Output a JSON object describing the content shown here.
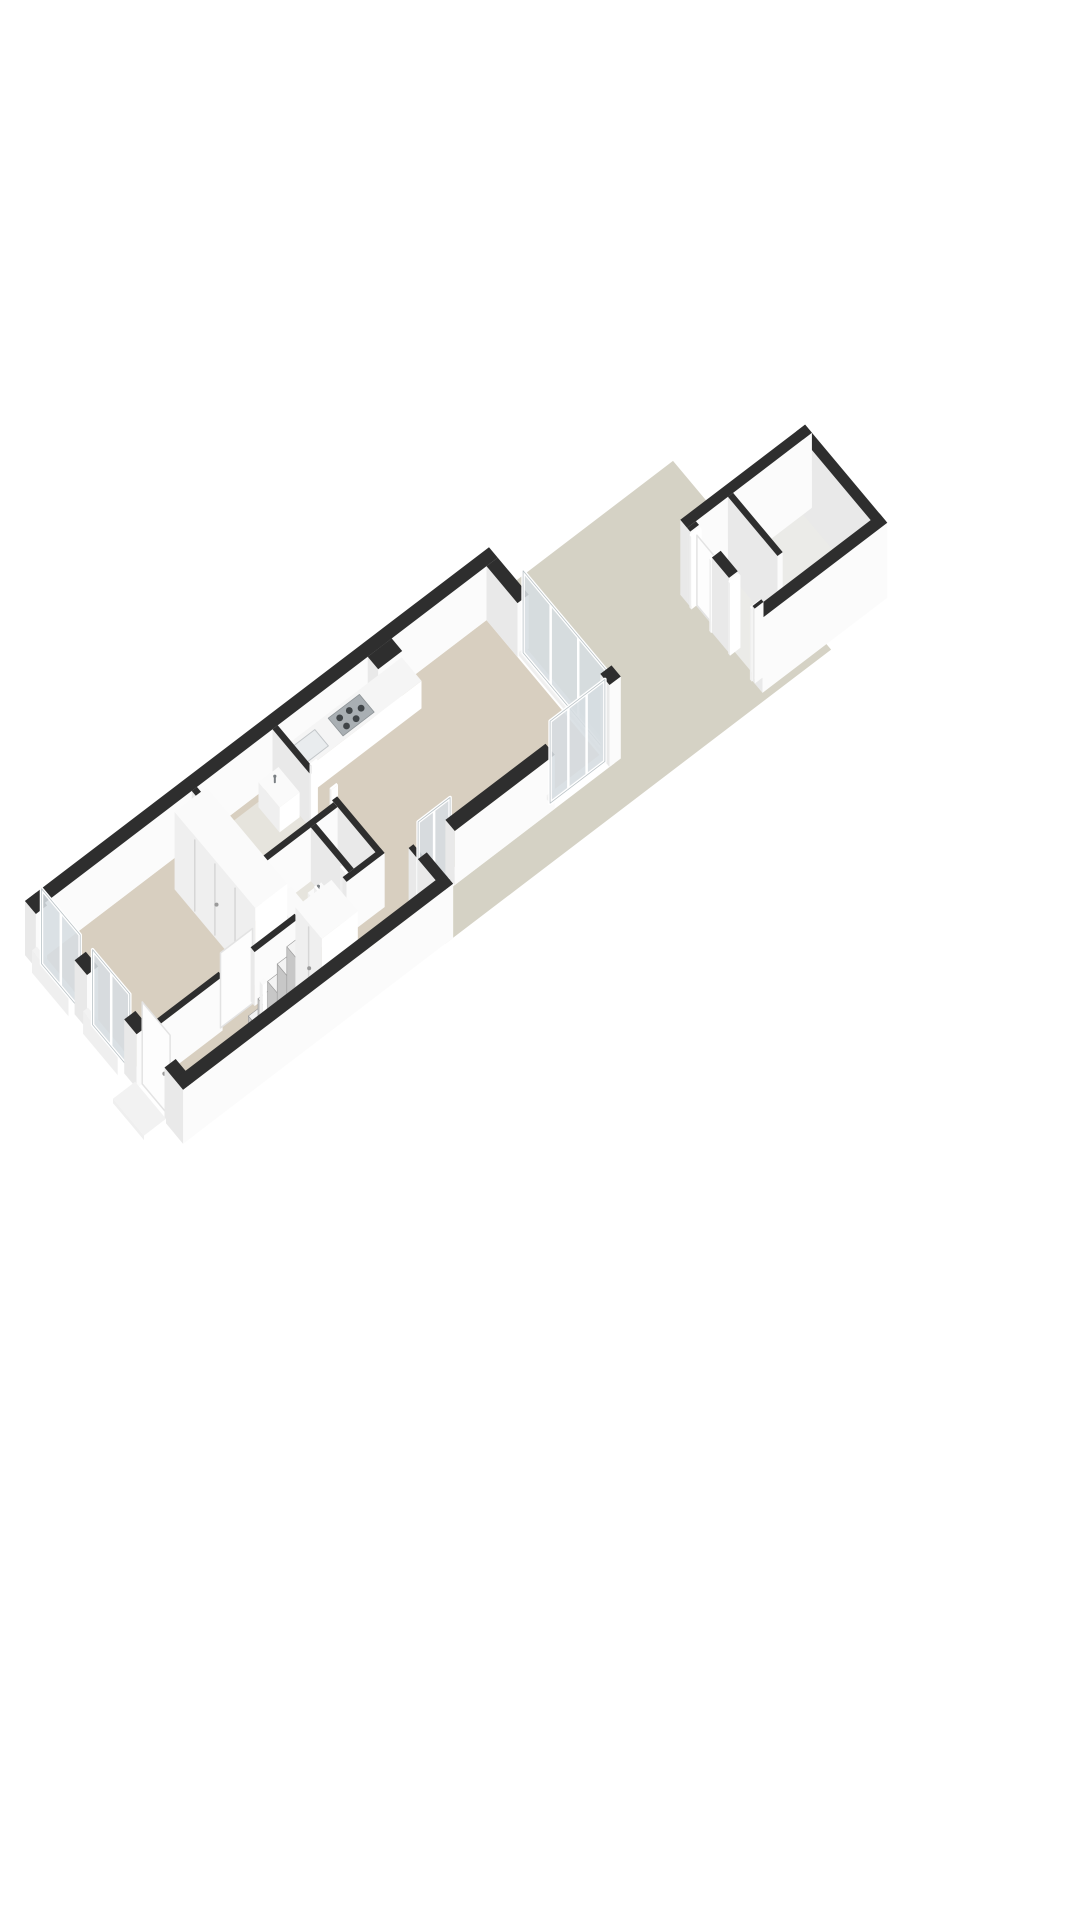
{
  "scene": {
    "width": 1080,
    "height": 1920,
    "background": "#ffffff",
    "projection": {
      "ox": 25,
      "oy": 955,
      "ux": 40,
      "uy": -30.5,
      "vx": 31,
      "vy": 37,
      "hz": 50
    },
    "colors": {
      "garden": "#d5d2c5",
      "floor": "#d8cfc0",
      "floor_wet": "#e6e4dd",
      "floor_shed": "#ebebe8",
      "wall_top": "#2e2e2e",
      "face_a": "#e9e9e9",
      "face_b": "#fbfbfb",
      "white_top": "#fafafa",
      "white_a": "#efefef",
      "white_b": "#ffffff",
      "glass": "#d6dde1",
      "frame": "#ffffff",
      "glass_edge": "#b9c2c6",
      "sill": "#f2f2f2",
      "counter_top": "#f5f5f5",
      "cooktop": "#a9afb3",
      "burner": "#3f4447",
      "sink_inset": "#e9ecee",
      "sink_edge": "#c2c6c9",
      "step_top": "#f3f3f3",
      "step_face": "#c7c7c7",
      "step_line": "#9b9b9b",
      "seam": "#d6d6d6",
      "handle": "#9a9a9a",
      "faucet": "#7a7f83",
      "leaf_edge": "#e3e3e3"
    },
    "elements": [
      {
        "type": "polygon",
        "name": "garden-floor",
        "fill": "garden",
        "pts": [
          [
            11.45,
            0
          ],
          [
            16.2,
            0
          ],
          [
            16.2,
            5.1
          ],
          [
            6.55,
            5.1
          ],
          [
            6.55,
            4.25
          ],
          [
            11.45,
            4.25
          ]
        ]
      },
      {
        "type": "polygon",
        "name": "shed-floor",
        "fill": "floor_shed",
        "pts": [
          [
            14.7,
            2.45
          ],
          [
            17.55,
            2.45
          ],
          [
            17.55,
            4.75
          ],
          [
            14.7,
            4.75
          ]
        ]
      },
      {
        "type": "box",
        "name": "shed-wall-back",
        "kind": "wall",
        "x": 17.5,
        "y": 2.3,
        "w": 0.22,
        "d": 2.62,
        "h": 1.5
      },
      {
        "type": "box",
        "name": "shed-wall-left",
        "kind": "wall",
        "x": 14.6,
        "y": 2.3,
        "w": 3.12,
        "d": 0.22,
        "h": 1.5
      },
      {
        "type": "box",
        "name": "shed-divider-wall",
        "kind": "wall",
        "x": 15.62,
        "y": 2.52,
        "w": 0.13,
        "d": 1.6,
        "h": 1.5
      },
      {
        "type": "box",
        "name": "shed-wall-front-right",
        "kind": "wall",
        "x": 14.6,
        "y": 4.7,
        "w": 3.12,
        "d": 0.25,
        "h": 1.5
      },
      {
        "type": "box",
        "name": "shed-front-wall-seg",
        "kind": "wall",
        "x": 14.6,
        "y": 2.52,
        "w": 0.22,
        "d": 0.1,
        "h": 1.5
      },
      {
        "type": "box",
        "name": "shed-door-frame-post",
        "kind": "frame",
        "x": 14.58,
        "y": 2.62,
        "w": 0.26,
        "d": 0.06,
        "h": 1.45
      },
      {
        "type": "leaf",
        "name": "shed-door-leaf",
        "axis": "y",
        "x": 14.72,
        "y1": 2.68,
        "y2": 3.26,
        "h": 1.4
      },
      {
        "type": "box",
        "name": "shed-door-frame-post",
        "kind": "frame",
        "x": 14.58,
        "y": 3.26,
        "w": 0.26,
        "d": 0.06,
        "h": 1.45
      },
      {
        "type": "box",
        "name": "shed-front-wall-seg",
        "kind": "wall",
        "x": 14.6,
        "y": 3.32,
        "w": 0.22,
        "d": 0.55,
        "h": 1.5
      },
      {
        "type": "box",
        "name": "shed-door-frame-post",
        "kind": "frame",
        "x": 14.58,
        "y": 3.87,
        "w": 0.26,
        "d": 0.06,
        "h": 1.45
      },
      {
        "type": "box",
        "name": "shed-door-frame-post",
        "kind": "frame",
        "x": 14.58,
        "y": 4.57,
        "w": 0.26,
        "d": 0.06,
        "h": 1.45
      },
      {
        "type": "box",
        "name": "shed-front-wall-seg",
        "kind": "wall",
        "x": 14.6,
        "y": 4.63,
        "w": 0.22,
        "d": 0.07,
        "h": 1.5
      },
      {
        "type": "polygon",
        "name": "house-floor",
        "fill": "floor",
        "pts": [
          [
            0.28,
            0.28
          ],
          [
            11.32,
            0.28
          ],
          [
            11.32,
            3.95
          ],
          [
            6.53,
            3.95
          ],
          [
            6.53,
            4.82
          ],
          [
            0.28,
            4.82
          ]
        ]
      },
      {
        "type": "polygon",
        "name": "bathroom-floor",
        "fill": "floor_wet",
        "pts": [
          [
            4.08,
            0.41
          ],
          [
            5.97,
            0.41
          ],
          [
            5.97,
            2.25
          ],
          [
            4.08,
            2.25
          ]
        ]
      },
      {
        "type": "polygon",
        "name": "toilet-floor",
        "fill": "floor_wet",
        "pts": [
          [
            4.08,
            2.38
          ],
          [
            5.3,
            2.38
          ],
          [
            5.3,
            3.6
          ],
          [
            4.08,
            3.6
          ]
        ]
      },
      {
        "type": "box",
        "name": "left-party-wall",
        "kind": "wall",
        "x": 0,
        "y": 0,
        "w": 11.6,
        "d": 0.28,
        "h": 1.08
      },
      {
        "type": "box",
        "name": "back-wall-segment",
        "kind": "wall",
        "x": 11.32,
        "y": 0.28,
        "w": 0.28,
        "d": 1.0,
        "h": 1.08
      },
      {
        "type": "box",
        "name": "sliding-door-sill",
        "kind": "sill",
        "x": 11.36,
        "y": 1.28,
        "w": 0.16,
        "d": 2.67,
        "h": 0.08
      },
      {
        "type": "glass",
        "name": "back-sliding-glass-door",
        "axis": "y",
        "x": 11.46,
        "y1": 1.28,
        "y2": 3.95,
        "h": 1.64,
        "panels": 3
      },
      {
        "type": "box",
        "name": "back-corner-post",
        "kind": "wall",
        "x": 11.32,
        "y": 3.95,
        "w": 0.28,
        "d": 0.3,
        "h": 1.64
      },
      {
        "type": "box",
        "name": "chimney-pier",
        "kind": "wall",
        "x": 8.35,
        "y": 0.28,
        "w": 0.6,
        "d": 0.34,
        "h": 1.08
      },
      {
        "type": "box",
        "name": "kitchen-counter",
        "kind": "counter",
        "x": 6.15,
        "y": 0.28,
        "w": 3.05,
        "d": 0.64,
        "h": 0.55
      },
      {
        "type": "toppoly",
        "name": "kitchen-sink-inset",
        "z": 0.55,
        "fill": "sink_inset",
        "stroke": "sink_edge",
        "pts": [
          [
            6.35,
            0.38
          ],
          [
            6.95,
            0.38
          ],
          [
            6.95,
            0.82
          ],
          [
            6.35,
            0.82
          ]
        ]
      },
      {
        "type": "cooktop",
        "name": "cooktop",
        "z": 0.55,
        "pts": [
          [
            7.3,
            0.36
          ],
          [
            8.08,
            0.36
          ],
          [
            8.08,
            0.84
          ],
          [
            7.3,
            0.84
          ]
        ],
        "burners": [
          [
            7.48,
            0.5
          ],
          [
            7.48,
            0.72
          ],
          [
            7.72,
            0.5
          ],
          [
            7.72,
            0.72
          ],
          [
            7.93,
            0.61
          ]
        ]
      },
      {
        "type": "box",
        "name": "bedroom-back-wall",
        "kind": "wall",
        "x": 3.95,
        "y": 0.28,
        "w": 0.13,
        "d": 3.45,
        "h": 1.08
      },
      {
        "type": "box",
        "name": "bathroom-wall-segment",
        "kind": "wall",
        "x": 5.97,
        "y": 0.28,
        "w": 0.13,
        "d": 1.22,
        "h": 1.08
      },
      {
        "type": "box",
        "name": "bathroom-door-post",
        "kind": "frame",
        "x": 5.95,
        "y": 1.5,
        "w": 0.17,
        "d": 0.05,
        "h": 1.3
      },
      {
        "type": "box",
        "name": "bathroom-door-post",
        "kind": "frame",
        "x": 5.95,
        "y": 2.15,
        "w": 0.17,
        "d": 0.05,
        "h": 1.3
      },
      {
        "type": "box",
        "name": "bathroom-wall-segment",
        "kind": "wall",
        "x": 5.97,
        "y": 2.2,
        "w": 0.13,
        "d": 1.53,
        "h": 1.08
      },
      {
        "type": "box",
        "name": "bathroom-toilet-divider-wall",
        "kind": "wall",
        "x": 4.08,
        "y": 2.25,
        "w": 1.89,
        "d": 0.13,
        "h": 1.08
      },
      {
        "type": "box",
        "name": "toilet-side-wall",
        "kind": "wall",
        "x": 5.3,
        "y": 2.38,
        "w": 0.13,
        "d": 1.22,
        "h": 1.08
      },
      {
        "type": "basin",
        "name": "bathroom-sink",
        "x": 5.45,
        "y": 0.5,
        "w": 0.5,
        "d": 0.68,
        "h": 0.5
      },
      {
        "type": "basin",
        "name": "toilet-hand-basin",
        "x": 4.82,
        "y": 2.9,
        "w": 0.34,
        "d": 0.42,
        "h": 0.45
      },
      {
        "type": "box",
        "name": "toilet-bowl",
        "kind": "white",
        "x": 4.25,
        "y": 2.55,
        "w": 0.42,
        "d": 0.55,
        "h": 0.4
      },
      {
        "type": "box",
        "name": "bedroom-closet",
        "kind": "white",
        "x": 3.12,
        "y": 0.8,
        "w": 0.8,
        "d": 2.6,
        "h": 1.55,
        "seams": [
          0.25,
          0.5,
          0.75
        ],
        "handle": true
      },
      {
        "type": "box",
        "name": "hall-wall-segment",
        "kind": "wall",
        "x": 0.28,
        "y": 3.6,
        "w": 1.77,
        "d": 0.13,
        "h": 1.08
      },
      {
        "type": "leaf",
        "name": "bedroom-door-leaf",
        "axis": "x",
        "x1": 2.05,
        "x2": 2.85,
        "y": 3.66,
        "h": 1.5
      },
      {
        "type": "box",
        "name": "hall-wall-segment",
        "kind": "wall",
        "x": 2.85,
        "y": 3.6,
        "w": 1.1,
        "d": 0.13,
        "h": 1.08
      },
      {
        "type": "box",
        "name": "toilet-hall-wall-segment",
        "kind": "wall",
        "x": 4.08,
        "y": 3.6,
        "w": 0.37,
        "d": 0.13,
        "h": 1.08
      },
      {
        "type": "box",
        "name": "toilet-door-post",
        "kind": "frame",
        "x": 4.45,
        "y": 3.58,
        "w": 0.05,
        "d": 0.17,
        "h": 1.3
      },
      {
        "type": "box",
        "name": "toilet-door-post",
        "kind": "frame",
        "x": 5.1,
        "y": 3.58,
        "w": 0.05,
        "d": 0.17,
        "h": 1.3
      },
      {
        "type": "box",
        "name": "toilet-hall-wall-segment",
        "kind": "wall",
        "x": 5.15,
        "y": 3.6,
        "w": 0.95,
        "d": 0.13,
        "h": 1.08
      },
      {
        "type": "steps",
        "name": "staircase",
        "x0": 2.5,
        "y": 3.98,
        "d": 0.78,
        "n": 5,
        "sw": 0.24,
        "hstep": 0.2
      },
      {
        "type": "box",
        "name": "stair-newel-post",
        "kind": "white",
        "x": 2.38,
        "y": 4.5,
        "w": 0.1,
        "d": 0.1,
        "h": 1.35
      },
      {
        "type": "box",
        "name": "stair-cupboard",
        "kind": "white",
        "x": 3.7,
        "y": 3.95,
        "w": 0.9,
        "d": 0.85,
        "h": 1.62,
        "seams": [
          0.5
        ],
        "handle": true
      },
      {
        "type": "box",
        "name": "living-side-wall-segment",
        "kind": "wall",
        "x": 6.53,
        "y": 3.95,
        "w": 0.12,
        "d": 0.3,
        "h": 1.08
      },
      {
        "type": "box",
        "name": "garden-door-sill",
        "kind": "sill",
        "x": 6.65,
        "y": 3.99,
        "w": 0.8,
        "d": 0.16,
        "h": 0.06
      },
      {
        "type": "glass",
        "name": "garden-glass-door",
        "axis": "x",
        "x1": 6.65,
        "x2": 7.45,
        "y": 4.1,
        "h": 1.64,
        "panels": 2
      },
      {
        "type": "box",
        "name": "living-side-wall-segment",
        "kind": "wall",
        "x": 7.45,
        "y": 3.95,
        "w": 2.5,
        "d": 0.3,
        "h": 1.08
      },
      {
        "type": "box",
        "name": "corner-window-sill",
        "kind": "sill",
        "x": 9.95,
        "y": 3.99,
        "w": 1.37,
        "d": 0.16,
        "h": 0.08
      },
      {
        "type": "glass",
        "name": "corner-window-wall",
        "axis": "x",
        "x1": 9.95,
        "x2": 11.32,
        "y": 4.1,
        "h": 1.64,
        "panels": 3
      },
      {
        "type": "box",
        "name": "setback-wall",
        "kind": "wall",
        "x": 6.53,
        "y": 4.25,
        "w": 0.22,
        "d": 0.85,
        "h": 1.08
      },
      {
        "type": "box",
        "name": "facade-wall-segment",
        "kind": "wall",
        "x": 0,
        "y": 0,
        "w": 0.28,
        "d": 0.35,
        "h": 1.08
      },
      {
        "type": "box",
        "name": "front-window-sill",
        "kind": "sill",
        "x": -0.12,
        "y": 0.38,
        "w": 0.12,
        "d": 1.18,
        "h": 0.45
      },
      {
        "type": "glass",
        "name": "front-window",
        "axis": "y",
        "x": 0.14,
        "y1": 0.35,
        "y2": 1.6,
        "h": 1.5,
        "panels": 2
      },
      {
        "type": "box",
        "name": "facade-wall-segment",
        "kind": "wall",
        "x": 0,
        "y": 1.6,
        "w": 0.28,
        "d": 0.4,
        "h": 1.08
      },
      {
        "type": "box",
        "name": "front-window-sill",
        "kind": "sill",
        "x": -0.12,
        "y": 2.03,
        "w": 0.12,
        "d": 1.12,
        "h": 0.45
      },
      {
        "type": "glass",
        "name": "front-window",
        "axis": "y",
        "x": 0.14,
        "y1": 2.0,
        "y2": 3.2,
        "h": 1.5,
        "panels": 2
      },
      {
        "type": "box",
        "name": "facade-wall-segment",
        "kind": "wall",
        "x": 0,
        "y": 3.2,
        "w": 0.28,
        "d": 0.4,
        "h": 1.08
      },
      {
        "type": "leaf",
        "name": "front-door-leaf",
        "axis": "y",
        "x": 0.14,
        "y1": 3.6,
        "y2": 4.5,
        "h": 1.64,
        "handle": true
      },
      {
        "type": "box",
        "name": "facade-wall-segment",
        "kind": "wall",
        "x": 0,
        "y": 4.5,
        "w": 0.28,
        "d": 0.6,
        "h": 1.08
      },
      {
        "type": "box",
        "name": "front-door-step",
        "kind": "sill",
        "x": -0.55,
        "y": 3.55,
        "w": 0.55,
        "d": 1.0,
        "h": 0.09
      },
      {
        "type": "box",
        "name": "front-right-wall",
        "kind": "wall",
        "x": 0,
        "y": 4.82,
        "w": 6.75,
        "d": 0.28,
        "h": 1.08
      }
    ]
  }
}
